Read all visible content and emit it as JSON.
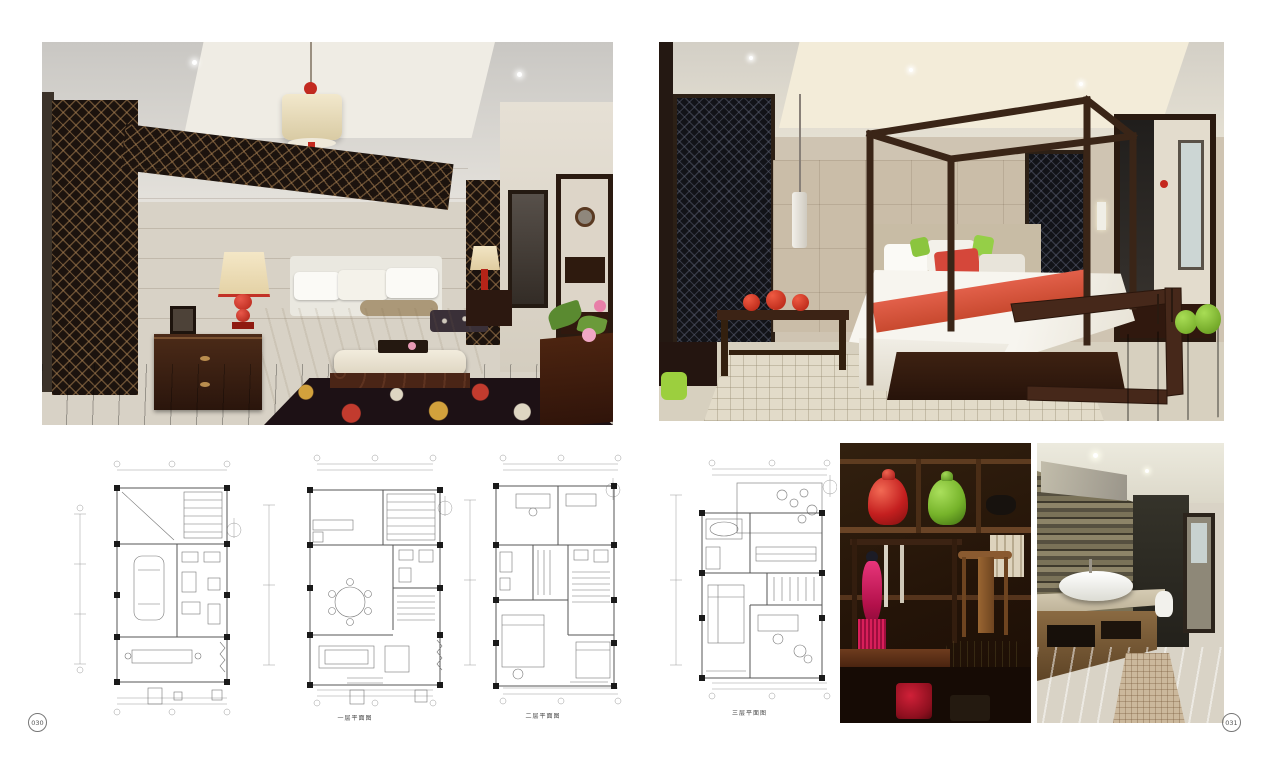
{
  "spread": {
    "left_page_number": "030",
    "right_page_number": "031"
  },
  "floor_plans": {
    "first_floor_label": "一层平面图",
    "second_floor_label": "二层平面图",
    "third_floor_label": "三层平面图"
  },
  "colors": {
    "page_background": "#ffffff",
    "accent_red": "#c4281e",
    "accent_coral": "#d6503c",
    "accent_green": "#7ab82c",
    "accent_magenta": "#d81f5a",
    "dark_wood": "#2e1a10",
    "floor_mahogany": "#46211a",
    "wall_beige": "#c9bda9",
    "plan_line": "#8a8a8a"
  }
}
